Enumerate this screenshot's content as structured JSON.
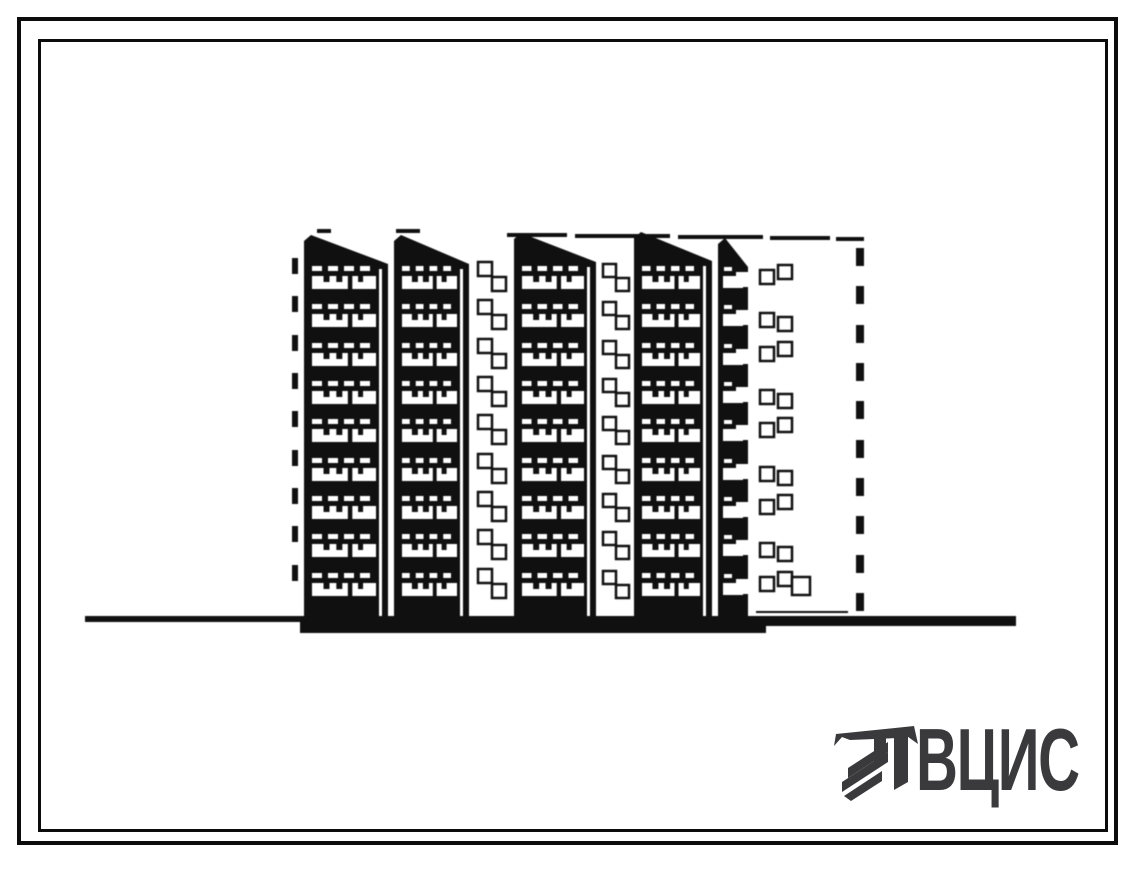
{
  "page": {
    "background": "#ffffff",
    "ink_color": "#101010",
    "logo_color": "#3a3a3c"
  },
  "logo": {
    "text": "ВЦИС",
    "icon": "hatched-column-logo-icon"
  },
  "drawing": {
    "subject": "nine-storey panel apartment building elevation",
    "ground": {
      "line": {
        "x": 85,
        "y": 616,
        "w": 931,
        "h": 6
      },
      "second_line": {
        "x": 420,
        "y": 622,
        "w": 596,
        "h": 4
      },
      "base_smudge": {
        "x": 300,
        "y": 620,
        "w": 466,
        "h": 13
      }
    },
    "roof_marks": [
      {
        "x": 317,
        "y": 229,
        "w": 14
      },
      {
        "x": 396,
        "y": 229,
        "w": 24
      },
      {
        "x": 507,
        "y": 233,
        "w": 60
      },
      {
        "x": 575,
        "y": 234,
        "w": 95
      },
      {
        "x": 678,
        "y": 235,
        "w": 85
      },
      {
        "x": 770,
        "y": 236,
        "w": 60
      },
      {
        "x": 836,
        "y": 237,
        "w": 28
      }
    ],
    "floor_band_y": [
      276,
      314,
      353,
      391,
      429,
      468,
      506,
      544,
      583
    ],
    "stack_bottom_y": 626,
    "balcony_stacks": [
      {
        "x": 304,
        "w": 84,
        "peak_y": 235
      },
      {
        "x": 394,
        "w": 75,
        "peak_y": 235
      },
      {
        "x": 514,
        "w": 82,
        "peak_y": 233
      },
      {
        "x": 634,
        "w": 78,
        "peak_y": 232
      },
      {
        "x": 718,
        "w": 30,
        "peak_y": 238,
        "narrow": true
      }
    ],
    "left_edge_ticks": {
      "x": 292,
      "w": 6,
      "h": 16,
      "dy": -18
    },
    "window_columns": [
      {
        "x_a": 478,
        "dy_a": -14,
        "x_b": 492,
        "dy_b": 1,
        "size": 14
      },
      {
        "x_a": 603,
        "dy_a": -12,
        "x_b": 616,
        "dy_b": 2,
        "size": 13
      }
    ],
    "end_wall": {
      "x_left_col": 760,
      "x_right_col": 778,
      "size": 14,
      "stagger_even": [
        -6,
        -11
      ],
      "stagger_odd": [
        -1,
        3
      ],
      "extra_window": {
        "x": 792,
        "y": 577,
        "size": 18
      },
      "base_line": {
        "x": 756,
        "y": 611,
        "w": 92,
        "h": 2
      }
    },
    "dashed_corner": {
      "x": 856,
      "w": 8,
      "dash_h": 18,
      "dy": -28,
      "extra_y": 593
    }
  }
}
